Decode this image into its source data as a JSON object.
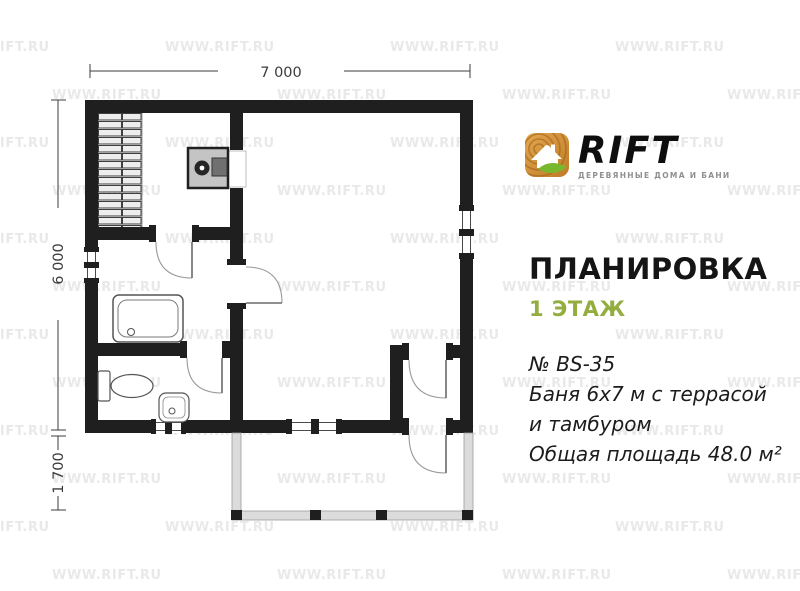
{
  "watermark": {
    "text": "WWW.RIFT.RU",
    "color": "#e9e9e9"
  },
  "logo": {
    "brand": "RIFT",
    "tagline": "ДЕРЕВЯННЫЕ ДОМА И БАНИ",
    "icon": "wood-log-house-leaf-icon",
    "colors": {
      "wood_light": "#e3a74f",
      "wood_dark": "#bf7a26",
      "ring": "#a2681c",
      "leaf_green": "#79b82e",
      "brand_text": "#0e0e0e",
      "tagline_text": "#8f8f8f"
    }
  },
  "panel": {
    "title": "ПЛАНИРОВКА",
    "floor_label": "1 ЭТАЖ",
    "floor_label_color": "#93ad3e",
    "description": {
      "lines": [
        "№ BS-35",
        "Баня 6х7 м с террасой",
        "и тамбуром",
        "Общая площадь 48.0 м²"
      ]
    }
  },
  "plan": {
    "dimensions": {
      "width": "7 000",
      "depth": "6 000",
      "terrace_depth": "1 700"
    },
    "colors": {
      "wall": "#1f1f1f",
      "fixture_outline": "#555555",
      "door_arc": "#9a9a9a",
      "bench_fill": "#ededed",
      "stove_fill": "#c4c4c4",
      "terrace_fill": "#dcdcdc",
      "dimension_text": "#3c3c3c"
    }
  }
}
